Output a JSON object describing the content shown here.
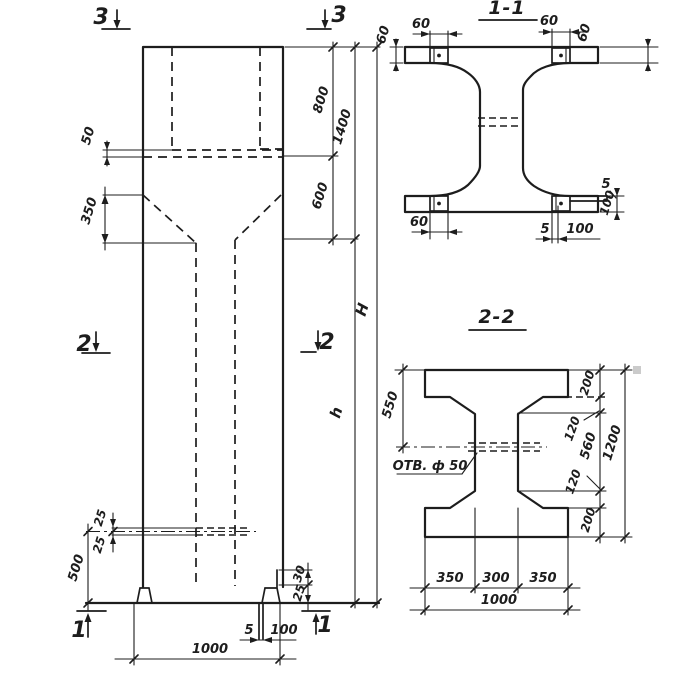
{
  "colors": {
    "ink": "#1d1d1d",
    "paper": "#ffffff",
    "artifact": "#cbcbcb"
  },
  "elevation": {
    "markers": {
      "top_left": "3",
      "top_right": "3",
      "mid_left": "2",
      "mid_right": "2",
      "bottom_left": "1",
      "bottom_right": "1"
    },
    "dims": {
      "seam_offset": "50",
      "taper_height": "350",
      "top_segment": "800",
      "head_height": "1400",
      "neck_segment": "600",
      "total_height": "H",
      "shaft_height": "h",
      "hole_upper": "25",
      "hole_lower": "25",
      "hole_elevation": "500",
      "foot_step_upper": "30",
      "foot_step_lower": "25",
      "base_plate_thickness": "5",
      "base_plate_length": "100",
      "base_width": "1000"
    }
  },
  "section_1_1": {
    "title": "1-1",
    "dims": {
      "plate_width_left": "60",
      "plate_width_right": "60",
      "flange_edge_left": "60",
      "flange_edge_right": "60",
      "plate_width_bottom": "60",
      "bottom_gap": "5",
      "bottom_plate_length": "100",
      "side_plate_thickness": "5",
      "side_plate_height": "100"
    }
  },
  "section_2_2": {
    "title": "2-2",
    "hole_callout": "ОТВ. ф 50",
    "dims": {
      "top_to_hole": "550",
      "flange_top": "200",
      "haunch_top": "120",
      "web_height": "560",
      "haunch_bottom": "120",
      "flange_bottom": "200",
      "section_height": "1200",
      "bottom_left": "350",
      "bottom_center": "300",
      "bottom_right": "350",
      "bottom_total": "1000"
    }
  }
}
